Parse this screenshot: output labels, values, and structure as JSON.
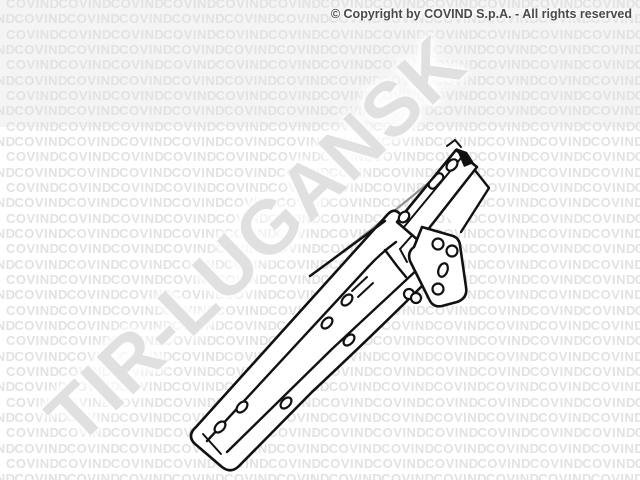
{
  "header": {
    "copyright_notice": "© Copyright by COVIND S.p.A. - All rights reserved",
    "copyright_color": "#4a4a4a"
  },
  "watermark": {
    "tile_text": "COVIND",
    "tile_rows": 32,
    "tiles_per_row": 14,
    "tile_color": "#e2e2e2",
    "diagonal_text": "TIR-LUGANSK",
    "diagonal_color": "#e0e0e0"
  },
  "illustration": {
    "subject": "truck-bracket-technical-line-drawing",
    "stroke_color": "#111111",
    "hidden_edge_color": "#909090"
  },
  "canvas": {
    "width": 640,
    "height": 480,
    "background": "#ffffff",
    "top_band_color": "#f3f4f3"
  }
}
